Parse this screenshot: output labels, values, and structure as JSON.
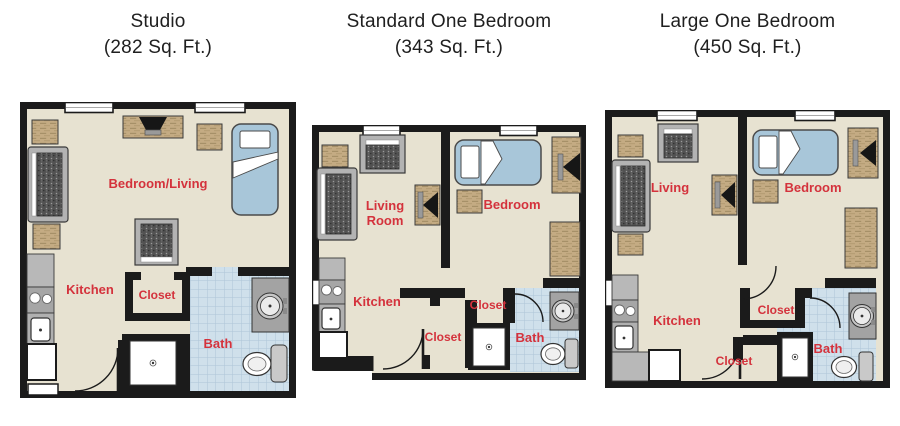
{
  "page": {
    "background": "#ffffff"
  },
  "colors": {
    "floor": "#e7e2d1",
    "wall": "#1b1b1b",
    "room_label": "#d4323c",
    "bath_tile": "#cfe0eb",
    "bath_tile_grid": "#adc5d7",
    "bed": "#a8c6d9",
    "wood_furniture": "#c4ab83",
    "gray_furniture": "#b3b3b3",
    "counter": "#b8b8b8",
    "title_text": "#1f1f1f"
  },
  "plans": [
    {
      "title": "Studio",
      "area": "(282 Sq. Ft.)",
      "labels": {
        "main": "Bedroom/Living",
        "kitchen": "Kitchen",
        "closet": "Closet",
        "bath": "Bath"
      }
    },
    {
      "title": "Standard One Bedroom",
      "area": "(343 Sq. Ft.)",
      "labels": {
        "living_line1": "Living",
        "living_line2": "Room",
        "bedroom": "Bedroom",
        "kitchen": "Kitchen",
        "closet_upper": "Closet",
        "closet_lower": "Closet",
        "bath": "Bath"
      }
    },
    {
      "title": "Large One Bedroom",
      "area": "(450 Sq. Ft.)",
      "labels": {
        "living": "Living",
        "bedroom": "Bedroom",
        "kitchen": "Kitchen",
        "closet_upper": "Closet",
        "closet_lower": "Closet",
        "bath": "Bath"
      }
    }
  ]
}
